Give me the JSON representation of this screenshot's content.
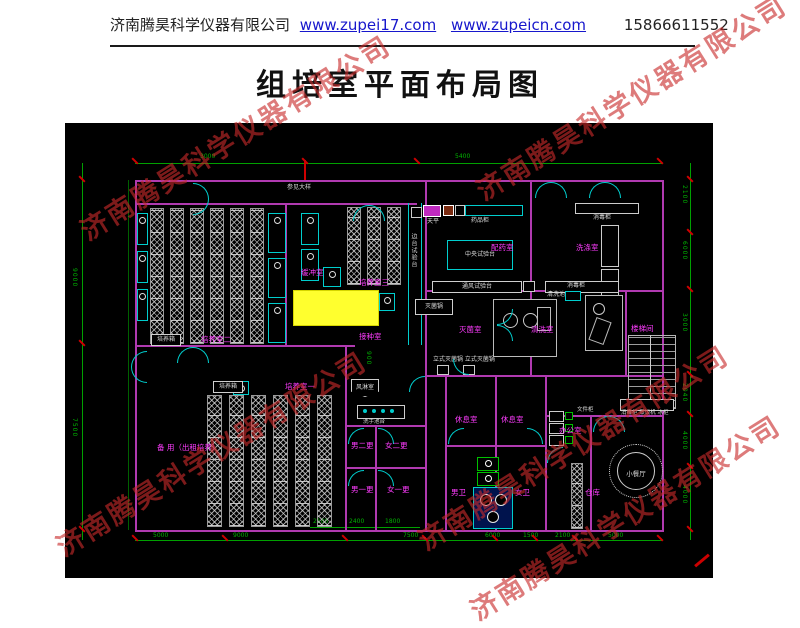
{
  "header": {
    "company": "济南腾昊科学仪器有限公司",
    "url1": "www.zupei17.com",
    "url2": "www.zupeicn.com",
    "phone": "15866611552"
  },
  "title": "组培室平面布局图",
  "watermark": "济南腾昊科学仪器有限公司",
  "plan": {
    "note_top": "参见大样",
    "rooms": {
      "peiyang1": "培养室一",
      "peiyang2": "培养室二",
      "peiyang3": "培养室三",
      "huanchong": "缓冲室",
      "jiezhong": "接种室",
      "peiyao": "配药室",
      "xidi": "洗涤室",
      "miejun": "灭菌室",
      "qingxi": "清洗室",
      "louti": "楼梯间",
      "fenglin": "风淋室",
      "nan2": "男二更",
      "nv2": "女二更",
      "nan1": "男一更",
      "nv1": "女一更",
      "xiuxi1": "休息室",
      "xiuxi2": "休息室",
      "nanwei": "男卫",
      "nvwei": "女卫",
      "bangong": "办公室",
      "cangku": "仓库",
      "canting": "小餐厅",
      "beiyong": "备 用（出租培养）"
    },
    "equipment": {
      "peiyangxiang": "培养箱",
      "peiyangxiang2": "培养箱",
      "tianping": "天平",
      "yaopingui": "药品柜",
      "zhongyang": "中央试验台",
      "tongfeng": "通风试验台",
      "biantai": "边台试验台",
      "xiaodugui": "消毒柜",
      "xiaodugui2": "消毒柜",
      "miejunguo": "灭菌锅",
      "lishi": "立式灭菌锅 立式灭菌锅",
      "qingxichi": "清洗池",
      "xishouchi": "洗手池台",
      "wenjiangui": "文件柜",
      "kitchen": "消毒柜 蒸饭机 冰柜"
    },
    "dims": {
      "top": [
        "3000",
        "5400"
      ],
      "left": [
        "9000",
        "7500"
      ],
      "right": [
        "2100",
        "6000",
        "3000",
        "2040",
        "4000",
        "4000"
      ],
      "bottom": [
        "5000",
        "9000",
        "7500",
        "6000",
        "1500",
        "2100",
        "5000"
      ],
      "bottom2": [
        "2100",
        "2400",
        "1800"
      ],
      "inner": "900"
    }
  }
}
